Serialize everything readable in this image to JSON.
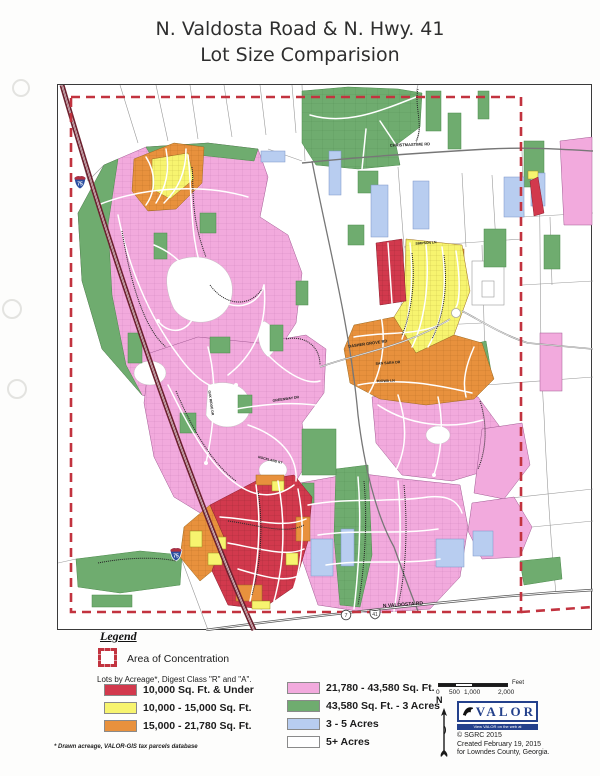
{
  "title": {
    "line1": "N. Valdosta Road & N. Hwy. 41",
    "line2": "Lot Size Comparision"
  },
  "map": {
    "labels": {
      "i75": "75",
      "route7": "7",
      "route41": "41",
      "n_valdosta_rd": "N VALDOSTA RD",
      "christmastime_rd": "CHRISTMASTIME RD",
      "dasher_grove_rd": "DASHER GROVE RD",
      "san_saba_dr": "SAN SABA DR",
      "kiowa_ln": "KIOWA LN",
      "greenway_dr": "GREENWAY DR",
      "oak_ridge_dr": "OAK RIDGE DR",
      "rockland_st": "ROCKLAND ST",
      "simpson_ln": "SIMPSON LN"
    }
  },
  "legend": {
    "title": "Legend",
    "area_of_concentration": "Area of Concentration",
    "heading": "Lots by Acreage*, Digest Class \"R\" and \"A\".",
    "classes": [
      {
        "label": "10,000 Sq. Ft. & Under",
        "color": "#d2394d"
      },
      {
        "label": "10,000 - 15,000 Sq. Ft.",
        "color": "#f7f46f"
      },
      {
        "label": "15,000 - 21,780 Sq. Ft.",
        "color": "#e8913d"
      },
      {
        "label": "21,780 - 43,580 Sq. Ft.",
        "color": "#f2aadd"
      },
      {
        "label": "43,580 Sq. Ft. - 3 Acres",
        "color": "#6fac6f"
      },
      {
        "label": "3 - 5 Acres",
        "color": "#b8cdf0"
      },
      {
        "label": "5+ Acres",
        "color": "#ffffff"
      }
    ],
    "footnote": "* Drawn acreage, VALOR-GIS tax parcels database"
  },
  "scalebar": {
    "unit": "Feet",
    "ticks": [
      "0",
      "500",
      "1,000",
      "2,000"
    ]
  },
  "north_label": "N",
  "credits": {
    "logo": "VALOR",
    "tagline": "View VALOR on the web at WWW.VALORGIS.COM",
    "line1": "© SGRC 2015",
    "line2": "Created February 19, 2015",
    "line3": "for Lowndes County, Georgia."
  }
}
